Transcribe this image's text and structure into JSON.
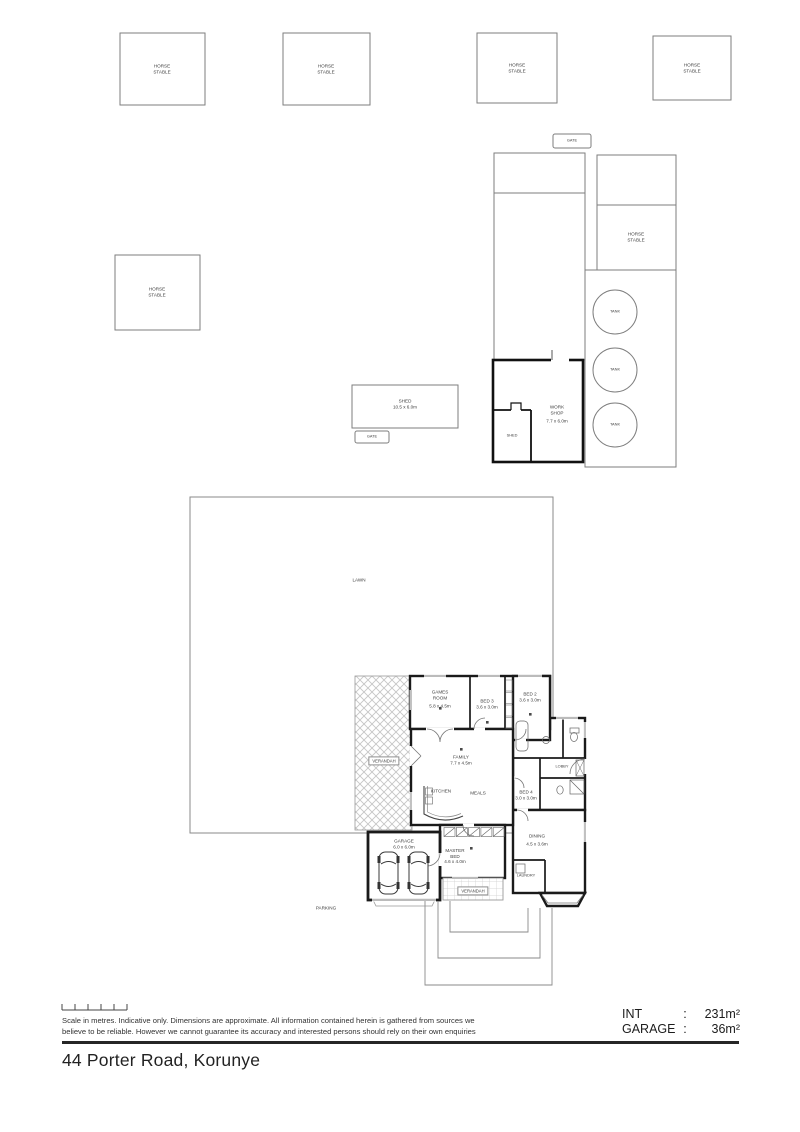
{
  "title": {
    "address": "44 Porter Road, Korunye"
  },
  "footer": {
    "disclaimer_line1": "Scale in metres. Indicative only. Dimensions are approximate. All information contained herein is gathered from sources we",
    "disclaimer_line2": "believe to be reliable. However we cannot guarantee its accuracy and interested persons should rely on their own enquiries",
    "areas": [
      {
        "label": "INT",
        "sep": ":",
        "value": "231m²"
      },
      {
        "label": "GARAGE",
        "sep": ":",
        "value": "36m²"
      }
    ]
  },
  "site": {
    "stables": [
      {
        "l1": "HORSE",
        "l2": "STABLE"
      },
      {
        "l1": "HORSE",
        "l2": "STABLE"
      },
      {
        "l1": "HORSE",
        "l2": "STABLE"
      },
      {
        "l1": "HORSE",
        "l2": "STABLE"
      },
      {
        "l1": "HORSE",
        "l2": "STABLE"
      },
      {
        "l1": "HORSE",
        "l2": "STABLE"
      }
    ],
    "gates": [
      {
        "label": "GATE"
      },
      {
        "label": "GATE"
      }
    ],
    "tanks": [
      {
        "label": "TANK"
      },
      {
        "label": "TANK"
      },
      {
        "label": "TANK"
      }
    ],
    "shed": {
      "name": "SHED",
      "dims": "10.5 x 6.0m"
    },
    "workshop": {
      "l1": "WORK",
      "l2": "SHOP",
      "dims": "7.7 x 6.0m",
      "inner_room": "SHED"
    },
    "lawn": "LAWN",
    "parking": "PARKING",
    "verandah": "VERANDAH",
    "porch": "VERANDAH"
  },
  "house": {
    "rooms": {
      "games": {
        "l1": "GAMES",
        "l2": "ROOM",
        "dims": "5.8 x 4.5m"
      },
      "bed3": {
        "name": "BED 3",
        "dims": "3.6 x 3.0m"
      },
      "bed2": {
        "name": "BED 2",
        "dims": "3.6 x 3.0m"
      },
      "family": {
        "name": "FAMILY",
        "dims": "7.7 x 4.5m"
      },
      "kitchen": {
        "name": "KITCHEN"
      },
      "meals": {
        "name": "MEALS"
      },
      "bed4": {
        "name": "BED 4",
        "dims": "3.0 x 3.0m"
      },
      "lobby": {
        "name": "LOBBY"
      },
      "dining": {
        "name": "DINING",
        "dims": "4.5 x 3.6m"
      },
      "laundry": {
        "name": "LAUNDRY"
      },
      "master": {
        "l1": "MASTER",
        "l2": "BED",
        "dims": "4.6 x 4.0m"
      },
      "garage": {
        "name": "GARAGE",
        "dims": "6.0 x 6.0m"
      }
    }
  }
}
